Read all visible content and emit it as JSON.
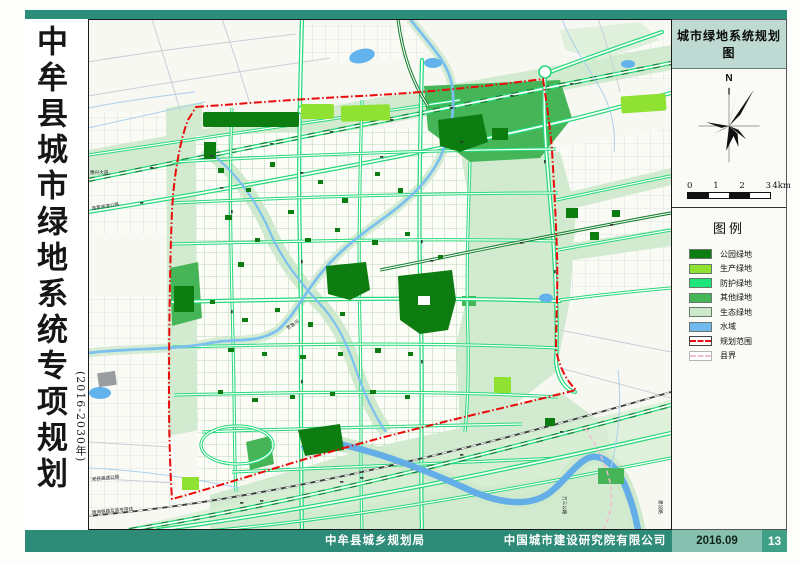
{
  "page": {
    "top_strip_color": "#2b8e7b",
    "title": {
      "main": "中牟县城市绿地系统专项规划",
      "sub": "(2016-2030年)"
    },
    "footer": {
      "org1": "中牟县城乡规划局",
      "org2": "中国城市建设研究院有限公司",
      "date": "2016.09",
      "page_number": "13",
      "bar_color": "#2e8b78",
      "date_box_color": "#86c1b0",
      "page_box_color": "#3f9f87"
    }
  },
  "sidebar": {
    "map_title": "城市绿地系统规划图",
    "compass": {
      "north_label": "N"
    },
    "scale_bar": {
      "tick_labels": [
        "0",
        "1",
        "2",
        "3"
      ],
      "end_label": "4km"
    },
    "legend": {
      "title": "图例",
      "items": [
        {
          "label": "公园绿地",
          "swatch": "fill",
          "color": "#0d7c11"
        },
        {
          "label": "生产绿地",
          "swatch": "fill",
          "color": "#8fe132"
        },
        {
          "label": "防护绿地",
          "swatch": "fill",
          "color": "#1ee47c"
        },
        {
          "label": "其他绿地",
          "swatch": "fill",
          "color": "#45b557"
        },
        {
          "label": "生态绿地",
          "swatch": "fill",
          "color": "#cde9cc"
        },
        {
          "label": "水域",
          "swatch": "fill",
          "color": "#6fb9ee"
        },
        {
          "label": "规划范围",
          "swatch": "dash",
          "color": "#e80d0d",
          "border": "#444444"
        },
        {
          "label": "县界",
          "swatch": "dash",
          "color": "#f2bcd0",
          "border": "#b5b5b5"
        }
      ]
    }
  },
  "map": {
    "labels": [
      {
        "text": "豫兴大道"
      },
      {
        "text": "连霍高速公路"
      },
      {
        "text": "郑民高速公路"
      },
      {
        "text": "陇海铁路及其专用线"
      },
      {
        "text": "万三公路"
      },
      {
        "text": "建设路"
      },
      {
        "text": "贾鲁河"
      }
    ]
  }
}
